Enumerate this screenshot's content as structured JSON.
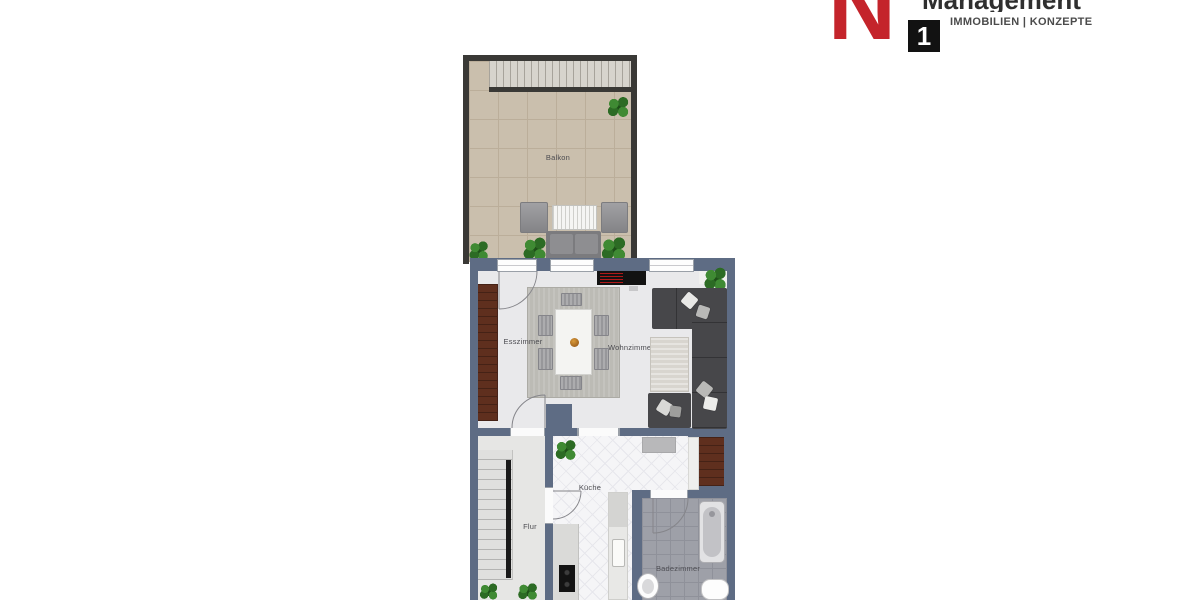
{
  "logo": {
    "letter": "N",
    "number": "1",
    "title": "Management",
    "subtitle": "IMMOBILIEN | KONZEPTE",
    "accent_red": "#c4242b",
    "badge_black": "#121212"
  },
  "floorplan": {
    "rooms": {
      "balkon": "Balkon",
      "esszimmer": "Esszimmer",
      "wohnzimmer": "Wohnzimmer",
      "kueche": "Küche",
      "flur": "Flur",
      "badezimmer": "Badezimmer"
    },
    "colors": {
      "balcony_wall": "#3a3936",
      "apartment_wall": "#5e6c84",
      "balcony_floor": "#c9bdab",
      "living_floor": "#e9e9eb",
      "kitchen_floor": "#f5f5f7",
      "bath_floor": "#9ea0a8",
      "wood": "#5f2f1e",
      "sofa": "#47474a"
    }
  }
}
